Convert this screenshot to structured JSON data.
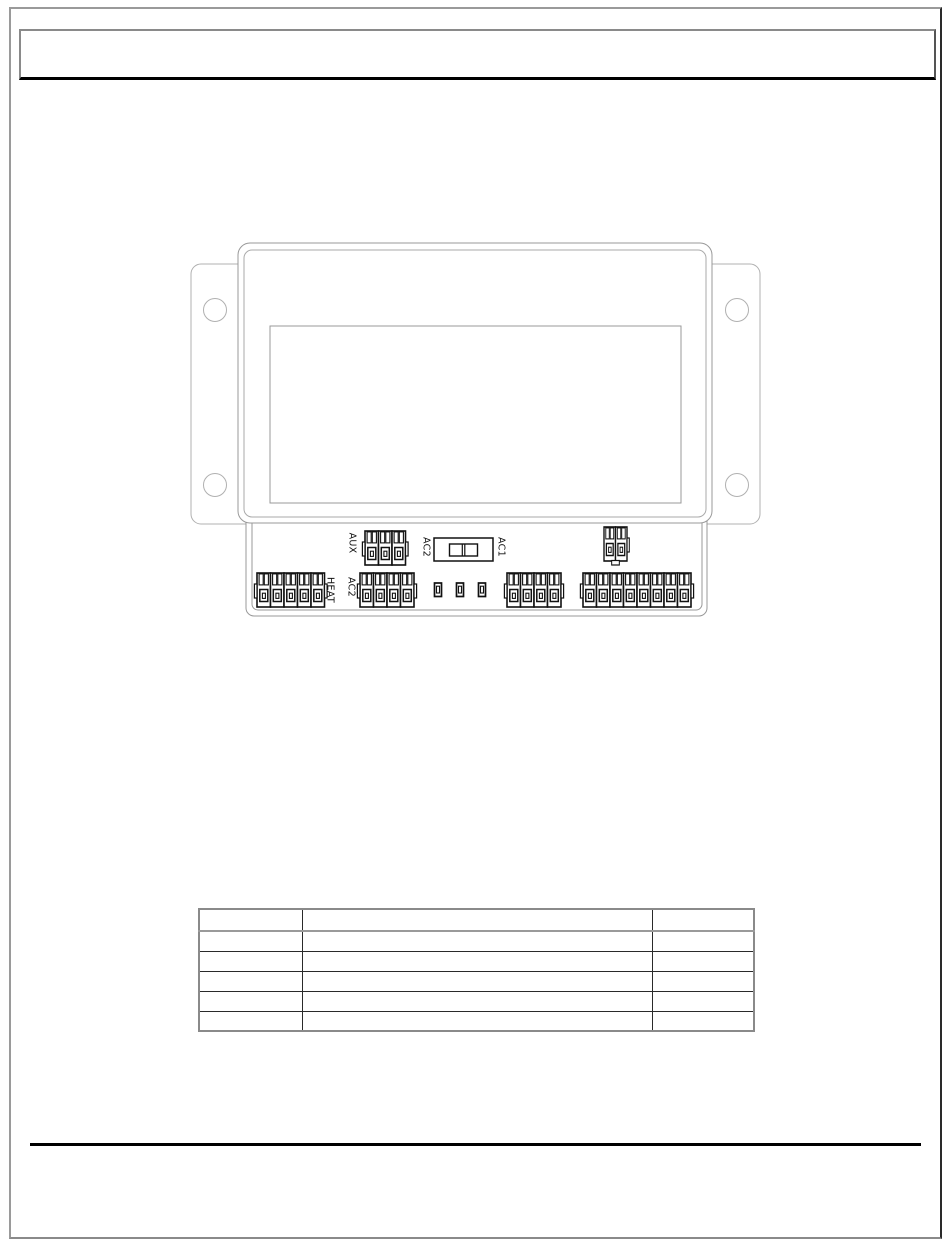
{
  "document": {
    "header": {
      "text": ""
    },
    "footer": {
      "text": ""
    }
  },
  "device_diagram": {
    "labels": {
      "aux": "AUX",
      "ac2_switch": "AC2",
      "ac1_switch": "AC1",
      "heat": "HEAT",
      "ac2_terminal": "AC2"
    }
  },
  "table": {
    "rows": [
      [
        "",
        "",
        ""
      ],
      [
        "",
        "",
        ""
      ],
      [
        "",
        "",
        ""
      ],
      [
        "",
        "",
        ""
      ],
      [
        "",
        "",
        ""
      ],
      [
        "",
        "",
        ""
      ]
    ]
  }
}
